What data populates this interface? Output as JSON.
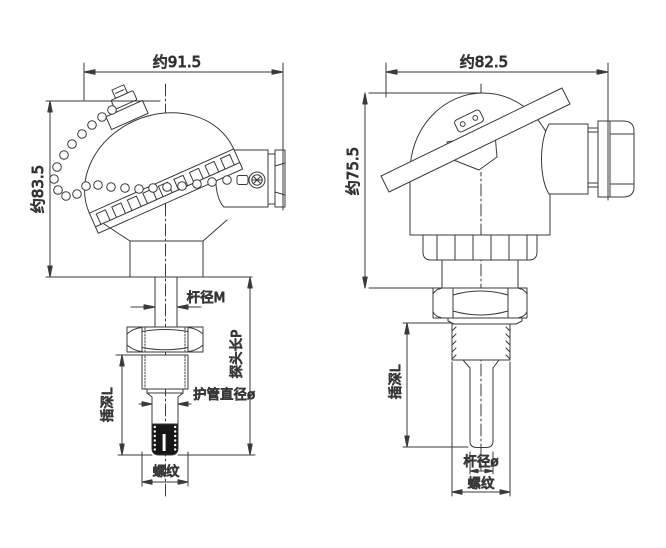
{
  "page": {
    "background": "#ffffff",
    "line_color": "#3a3a3a"
  },
  "left_figure": {
    "width_dimension": "约91.5",
    "height_dimension": "约83.5",
    "stem_diameter_label": "杆径M",
    "insertion_depth_label": "插深L",
    "probe_length_label": "探头长P",
    "sheath_diameter_label": "护管直径ø",
    "thread_label": "螺纹"
  },
  "right_figure": {
    "width_dimension": "约82.5",
    "height_dimension": "约75.5",
    "insertion_depth_label": "插深L",
    "stem_diameter_label": "杆径ø",
    "thread_label": "螺纹"
  }
}
